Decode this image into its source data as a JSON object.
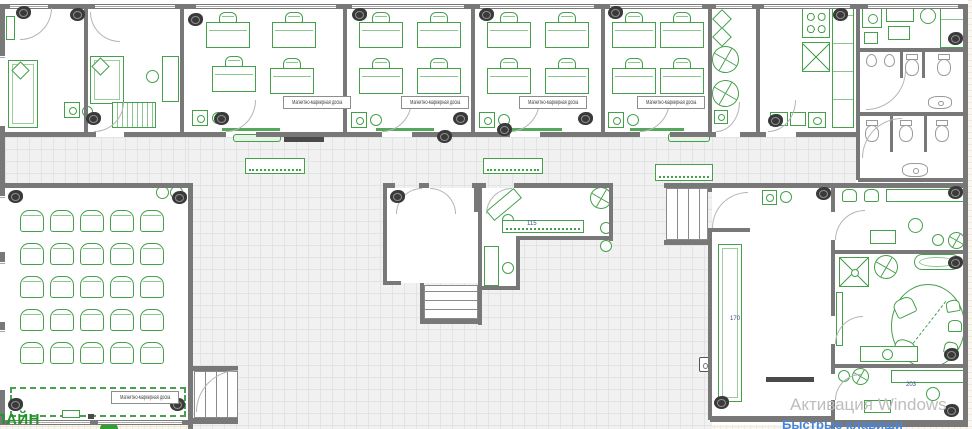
{
  "labels": {
    "marker_board": "Магнитно-маркерная доска",
    "logo": "ЛАЙН",
    "watermark_line1": "Активация Windows",
    "watermark_line2": "Быстрые клавиши"
  },
  "colors": {
    "furniture_green": "#44a04a",
    "wall_gray": "#787878",
    "camera_dark": "#3a3a3a",
    "fixture_gray": "#9a9a9a",
    "floor_bg": "#f1f1f1",
    "watermark_gray": "#bdbdbd",
    "hotkeys_blue": "#4a86d8",
    "logo_green": "#1f9427"
  },
  "dimensions": [
    {
      "text": "115",
      "x": 527,
      "y": 221
    },
    {
      "text": "170",
      "x": 730,
      "y": 316
    },
    {
      "text": "203",
      "x": 906,
      "y": 382
    }
  ],
  "marker_boards": [
    [
      283,
      96
    ],
    [
      401,
      96
    ],
    [
      519,
      96
    ],
    [
      637,
      96
    ],
    [
      111,
      391
    ]
  ],
  "auditorium": {
    "x0": 20,
    "y0": 210,
    "dx": 30,
    "dy": 33,
    "cols": 5,
    "rows": 5,
    "w": 24,
    "h": 22
  },
  "classroom_desks": [
    [
      206,
      12
    ],
    [
      272,
      12
    ],
    [
      212,
      56
    ],
    [
      270,
      58
    ],
    [
      359,
      12
    ],
    [
      417,
      12
    ],
    [
      359,
      58
    ],
    [
      417,
      58
    ],
    [
      487,
      12
    ],
    [
      545,
      12
    ],
    [
      487,
      58
    ],
    [
      545,
      58
    ],
    [
      612,
      12
    ],
    [
      660,
      12
    ],
    [
      612,
      58
    ],
    [
      660,
      58
    ]
  ],
  "scene": {
    "grids": [
      [
        5,
        137,
        183,
        46
      ],
      [
        188,
        137,
        524,
        292
      ],
      [
        712,
        137,
        144,
        46
      ]
    ],
    "outside": [
      [
        0,
        425,
        188,
        4
      ],
      [
        858,
        179,
        110,
        5
      ]
    ],
    "whites": [
      [
        387,
        188,
        91,
        95
      ],
      [
        482,
        188,
        131,
        50
      ],
      [
        482,
        238,
        38,
        48
      ],
      [
        712,
        188,
        119,
        228
      ],
      [
        835,
        188,
        129,
        62
      ],
      [
        835,
        254,
        129,
        110
      ],
      [
        835,
        368,
        129,
        52
      ],
      [
        5,
        188,
        183,
        232
      ]
    ],
    "furniture": [
      [
        "g",
        6,
        16,
        9,
        24
      ],
      [
        "couch",
        8,
        60,
        30,
        68
      ],
      [
        "diam",
        14,
        64,
        13,
        13
      ],
      [
        "couch",
        90,
        56,
        34,
        48
      ],
      [
        "diam",
        94,
        60,
        13,
        13
      ],
      [
        "g",
        162,
        56,
        17,
        46
      ],
      [
        "ring",
        146,
        70,
        13,
        13
      ],
      [
        "piano",
        112,
        102,
        44,
        26
      ],
      [
        "sinksq",
        64,
        102,
        16,
        16
      ],
      [
        "ring",
        82,
        106,
        11,
        11
      ],
      [
        "sinksq",
        192,
        110,
        16,
        16
      ],
      [
        "ring",
        212,
        112,
        12,
        12
      ],
      [
        "sinksq",
        351,
        112,
        16,
        16
      ],
      [
        "ring",
        370,
        114,
        12,
        12
      ],
      [
        "sinksq",
        479,
        112,
        16,
        16
      ],
      [
        "ring",
        498,
        114,
        12,
        12
      ],
      [
        "sinksq",
        608,
        112,
        16,
        16
      ],
      [
        "ring",
        627,
        114,
        12,
        12
      ],
      [
        "board",
        222,
        128,
        58,
        3
      ],
      [
        "board",
        376,
        128,
        58,
        3
      ],
      [
        "board",
        504,
        128,
        58,
        3
      ],
      [
        "board",
        630,
        128,
        54,
        3
      ],
      [
        "gbar",
        233,
        134,
        48,
        8
      ],
      [
        "tv",
        284,
        137,
        40,
        5
      ],
      [
        "dotb",
        245,
        158,
        60,
        16
      ],
      [
        "dotb",
        483,
        158,
        60,
        16
      ],
      [
        "dotb",
        655,
        164,
        58,
        17
      ],
      [
        "gbar",
        668,
        133,
        42,
        9
      ],
      [
        "diam",
        715,
        12,
        14,
        14
      ],
      [
        "diam",
        715,
        30,
        14,
        14
      ],
      [
        "pin",
        712,
        46,
        27,
        27
      ],
      [
        "pin",
        712,
        80,
        27,
        27
      ],
      [
        "sinksq",
        714,
        110,
        14,
        14
      ],
      [
        "stove",
        802,
        8,
        28,
        30
      ],
      [
        "sinkx",
        802,
        42,
        28,
        30
      ],
      [
        "counter",
        832,
        6,
        22,
        122
      ],
      [
        "g",
        770,
        112,
        18,
        14
      ],
      [
        "g",
        790,
        112,
        16,
        14
      ],
      [
        "sinksq",
        808,
        112,
        18,
        16
      ],
      [
        "sinksq",
        862,
        8,
        20,
        20
      ],
      [
        "g",
        886,
        6,
        28,
        16
      ],
      [
        "ring",
        920,
        8,
        16,
        16
      ],
      [
        "g",
        888,
        26,
        22,
        14
      ],
      [
        "counter",
        940,
        6,
        24,
        42
      ],
      [
        "g",
        864,
        32,
        14,
        12
      ],
      [
        "urinal",
        866,
        54,
        11,
        13
      ],
      [
        "urinal",
        884,
        54,
        11,
        13
      ],
      [
        "toilet",
        904,
        54,
        16,
        22
      ],
      [
        "toilet",
        936,
        54,
        16,
        22
      ],
      [
        "sinkov",
        928,
        96,
        24,
        13
      ],
      [
        "toilet",
        864,
        120,
        16,
        22
      ],
      [
        "toilet",
        898,
        120,
        16,
        22
      ],
      [
        "toilet",
        934,
        120,
        16,
        22
      ],
      [
        "sinkov",
        902,
        163,
        26,
        14
      ],
      [
        "ring",
        156,
        186,
        13,
        13
      ],
      [
        "ring",
        170,
        186,
        13,
        13
      ],
      [
        "stage",
        10,
        387,
        176,
        30
      ],
      [
        "g",
        62,
        410,
        18,
        8
      ],
      [
        "tv",
        88,
        414,
        6,
        5
      ],
      [
        "semic",
        100,
        421,
        18,
        8
      ],
      [
        "g",
        486,
        198,
        36,
        13,
        -40
      ],
      [
        "ring",
        502,
        214,
        12,
        12
      ],
      [
        "dotb",
        502,
        220,
        82,
        13
      ],
      [
        "pin",
        590,
        187,
        22,
        22
      ],
      [
        "g",
        484,
        246,
        15,
        40
      ],
      [
        "ring",
        502,
        262,
        12,
        12
      ],
      [
        "ring",
        600,
        222,
        12,
        12
      ],
      [
        "ring",
        600,
        240,
        12,
        12
      ],
      [
        "stv",
        666,
        188,
        42,
        52
      ],
      [
        "sth",
        424,
        285,
        54,
        34
      ],
      [
        "stv",
        194,
        371,
        44,
        47
      ],
      [
        "couch",
        718,
        244,
        24,
        158
      ],
      [
        "sinksq",
        762,
        190,
        15,
        15
      ],
      [
        "ring",
        780,
        191,
        12,
        12
      ],
      [
        "tv",
        766,
        377,
        48,
        5
      ],
      [
        "spk",
        699,
        357,
        11,
        15
      ],
      [
        "armch",
        842,
        189,
        15,
        13
      ],
      [
        "armch",
        864,
        189,
        15,
        13
      ],
      [
        "g",
        886,
        189,
        78,
        13
      ],
      [
        "ring",
        908,
        218,
        15,
        15
      ],
      [
        "g",
        870,
        230,
        26,
        14
      ],
      [
        "ring",
        932,
        234,
        12,
        12
      ],
      [
        "pin",
        948,
        232,
        17,
        17
      ],
      [
        "tablex",
        839,
        257,
        30,
        30
      ],
      [
        "pin",
        874,
        255,
        24,
        24
      ],
      [
        "tub",
        914,
        254,
        46,
        16
      ],
      [
        "g",
        836,
        292,
        7,
        54
      ],
      [
        "oval",
        891,
        284,
        74,
        84
      ],
      [
        "armch",
        894,
        298,
        21,
        18,
        -25
      ],
      [
        "armch",
        894,
        340,
        21,
        18,
        20
      ],
      [
        "armch",
        946,
        300,
        14,
        12,
        -10
      ],
      [
        "armch",
        948,
        320,
        14,
        12,
        0
      ],
      [
        "armch",
        944,
        342,
        14,
        12,
        12
      ],
      [
        "g",
        860,
        346,
        58,
        16
      ],
      [
        "ring",
        882,
        349,
        11,
        11
      ],
      [
        "ring",
        838,
        370,
        12,
        12
      ],
      [
        "pin",
        852,
        368,
        17,
        17
      ],
      [
        "g",
        891,
        370,
        74,
        13
      ],
      [
        "ring",
        926,
        387,
        14,
        14
      ],
      [
        "g",
        864,
        400,
        27,
        13
      ]
    ],
    "walls": [
      [
        0,
        4,
        968,
        5
      ],
      [
        0,
        4,
        5,
        421
      ],
      [
        963,
        4,
        5,
        423
      ],
      [
        84,
        4,
        4,
        128
      ],
      [
        180,
        4,
        4,
        128
      ],
      [
        343,
        4,
        4,
        128
      ],
      [
        471,
        4,
        4,
        128
      ],
      [
        601,
        4,
        4,
        128
      ],
      [
        708,
        4,
        4,
        128
      ],
      [
        756,
        4,
        4,
        128
      ],
      [
        856,
        4,
        4,
        176
      ],
      [
        0,
        132,
        96,
        5
      ],
      [
        124,
        132,
        102,
        5
      ],
      [
        256,
        132,
        126,
        5
      ],
      [
        412,
        132,
        98,
        5
      ],
      [
        540,
        132,
        100,
        5
      ],
      [
        670,
        132,
        46,
        5
      ],
      [
        740,
        132,
        26,
        5
      ],
      [
        796,
        132,
        62,
        5
      ],
      [
        858,
        48,
        110,
        4
      ],
      [
        858,
        112,
        110,
        4
      ],
      [
        858,
        178,
        110,
        4
      ],
      [
        900,
        52,
        3,
        26
      ],
      [
        922,
        52,
        3,
        26
      ],
      [
        890,
        116,
        3,
        36
      ],
      [
        924,
        116,
        3,
        36
      ],
      [
        0,
        183,
        192,
        5
      ],
      [
        188,
        183,
        5,
        246
      ],
      [
        0,
        420,
        190,
        5
      ],
      [
        383,
        183,
        12,
        5
      ],
      [
        419,
        183,
        10,
        5
      ],
      [
        472,
        183,
        10,
        5
      ],
      [
        474,
        188,
        4,
        24
      ],
      [
        383,
        188,
        4,
        95
      ],
      [
        478,
        183,
        4,
        142
      ],
      [
        383,
        281,
        18,
        4
      ],
      [
        420,
        283,
        4,
        40
      ],
      [
        420,
        319,
        62,
        5
      ],
      [
        478,
        183,
        8,
        5
      ],
      [
        514,
        183,
        99,
        5
      ],
      [
        609,
        183,
        4,
        58
      ],
      [
        516,
        236,
        97,
        4
      ],
      [
        516,
        240,
        4,
        48
      ],
      [
        478,
        286,
        42,
        4
      ],
      [
        664,
        183,
        45,
        5
      ],
      [
        664,
        240,
        45,
        5
      ],
      [
        708,
        183,
        4,
        9
      ],
      [
        708,
        228,
        4,
        192
      ],
      [
        192,
        366,
        46,
        5
      ],
      [
        192,
        418,
        46,
        6
      ],
      [
        712,
        183,
        123,
        5
      ],
      [
        712,
        228,
        38,
        4
      ],
      [
        710,
        416,
        125,
        6
      ],
      [
        831,
        183,
        4,
        29
      ],
      [
        831,
        240,
        4,
        76
      ],
      [
        831,
        344,
        4,
        30
      ],
      [
        831,
        400,
        4,
        29
      ],
      [
        835,
        183,
        133,
        5
      ],
      [
        835,
        250,
        133,
        4
      ],
      [
        835,
        364,
        133,
        4
      ],
      [
        833,
        420,
        135,
        7
      ]
    ],
    "windows": [
      [
        10,
        5,
        38,
        3
      ],
      [
        95,
        5,
        80,
        3
      ],
      [
        196,
        5,
        140,
        3
      ],
      [
        352,
        5,
        112,
        3
      ],
      [
        480,
        5,
        114,
        3
      ],
      [
        610,
        5,
        92,
        3
      ],
      [
        716,
        5,
        36,
        3
      ],
      [
        764,
        5,
        86,
        3
      ],
      [
        868,
        5,
        90,
        3
      ],
      [
        0,
        56,
        5,
        70
      ],
      [
        0,
        196,
        5,
        56
      ],
      [
        0,
        262,
        5,
        60
      ],
      [
        0,
        330,
        5,
        60
      ],
      [
        10,
        421,
        80,
        3
      ],
      [
        98,
        421,
        84,
        3
      ]
    ],
    "doors": [
      [
        20,
        8,
        32,
        32,
        "br"
      ],
      [
        90,
        12,
        30,
        30,
        "bl"
      ],
      [
        94,
        102,
        30,
        30,
        "br"
      ],
      [
        226,
        100,
        30,
        32,
        "br"
      ],
      [
        382,
        100,
        30,
        32,
        "br"
      ],
      [
        510,
        100,
        30,
        32,
        "br"
      ],
      [
        640,
        100,
        30,
        32,
        "br"
      ],
      [
        768,
        100,
        28,
        32,
        "br"
      ],
      [
        716,
        102,
        24,
        30,
        "br"
      ],
      [
        396,
        188,
        26,
        26,
        "tl"
      ],
      [
        430,
        188,
        26,
        26,
        "tr"
      ],
      [
        486,
        188,
        26,
        26,
        "tl"
      ],
      [
        712,
        192,
        36,
        36,
        "tl"
      ],
      [
        835,
        210,
        30,
        30,
        "tl"
      ],
      [
        835,
        316,
        28,
        28,
        "tl"
      ],
      [
        835,
        374,
        26,
        26,
        "tl"
      ],
      [
        196,
        370,
        42,
        42,
        "tl"
      ],
      [
        866,
        70,
        40,
        40,
        "br"
      ],
      [
        862,
        118,
        40,
        40,
        "tl"
      ]
    ],
    "cameras": [
      [
        16,
        6
      ],
      [
        70,
        8
      ],
      [
        188,
        13
      ],
      [
        352,
        8
      ],
      [
        479,
        8
      ],
      [
        608,
        6
      ],
      [
        833,
        8
      ],
      [
        948,
        32
      ],
      [
        86,
        112
      ],
      [
        214,
        112
      ],
      [
        453,
        112
      ],
      [
        578,
        112
      ],
      [
        768,
        114
      ],
      [
        437,
        130
      ],
      [
        497,
        123
      ],
      [
        8,
        190
      ],
      [
        172,
        191
      ],
      [
        8,
        398
      ],
      [
        170,
        398
      ],
      [
        390,
        190
      ],
      [
        816,
        187
      ],
      [
        714,
        396
      ],
      [
        948,
        186
      ],
      [
        948,
        256
      ],
      [
        944,
        348
      ],
      [
        944,
        404
      ]
    ]
  }
}
